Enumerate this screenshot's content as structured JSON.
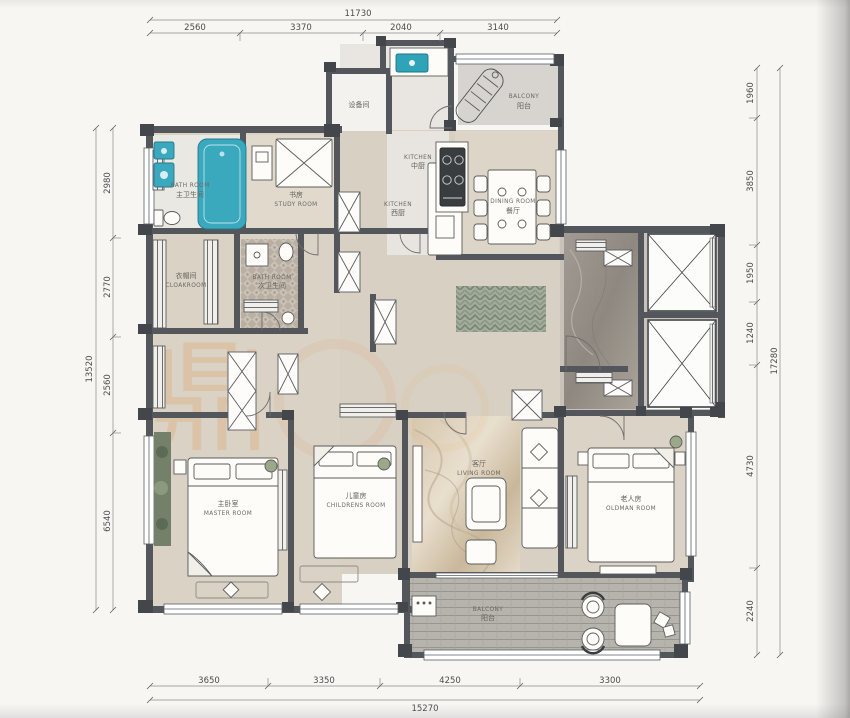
{
  "plan": {
    "watermark": {
      "char": "鼎",
      "color": "#e08a3c"
    },
    "dims": {
      "top": {
        "total": "11730",
        "segments": [
          "2560",
          "3370",
          "2040",
          "3140"
        ]
      },
      "left": {
        "total": "13520",
        "segments": [
          "2980",
          "2770",
          "2560",
          "6540"
        ]
      },
      "right": {
        "total": "17280",
        "segments": [
          "1960",
          "3850",
          "1950",
          "1240",
          "4730",
          "2240"
        ]
      },
      "bottom": {
        "total": "15270",
        "segments": [
          "3650",
          "3350",
          "4250",
          "3300"
        ]
      }
    },
    "rooms": {
      "equipment": {
        "zh": "设备间",
        "en": ""
      },
      "kitchen_main": {
        "en": "KITCHEN",
        "zh": "中厨"
      },
      "balcony_top": {
        "en": "BALCONY",
        "zh": "阳台"
      },
      "bath_master": {
        "en": "BATH ROOM",
        "zh": "主卫生间"
      },
      "study": {
        "zh": "书房",
        "en": "STUDY ROOM"
      },
      "kitchen_west": {
        "en": "KITCHEN",
        "zh": "西厨"
      },
      "dining": {
        "en": "DINING ROOM",
        "zh": "餐厅"
      },
      "cloak": {
        "zh": "衣帽间",
        "en": "CLOAKROOM"
      },
      "bath_guest": {
        "en": "BATH ROOM",
        "zh": "次卫生间"
      },
      "master": {
        "zh": "主卧室",
        "en": "MASTER ROOM"
      },
      "children": {
        "zh": "儿童房",
        "en": "CHILDRENS ROOM"
      },
      "living": {
        "zh": "客厅",
        "en": "LIVING ROOM"
      },
      "oldman": {
        "zh": "老人房",
        "en": "OLDMAN ROOM"
      },
      "balcony_bottom": {
        "en": "BALCONY",
        "zh": "阳台"
      }
    }
  }
}
